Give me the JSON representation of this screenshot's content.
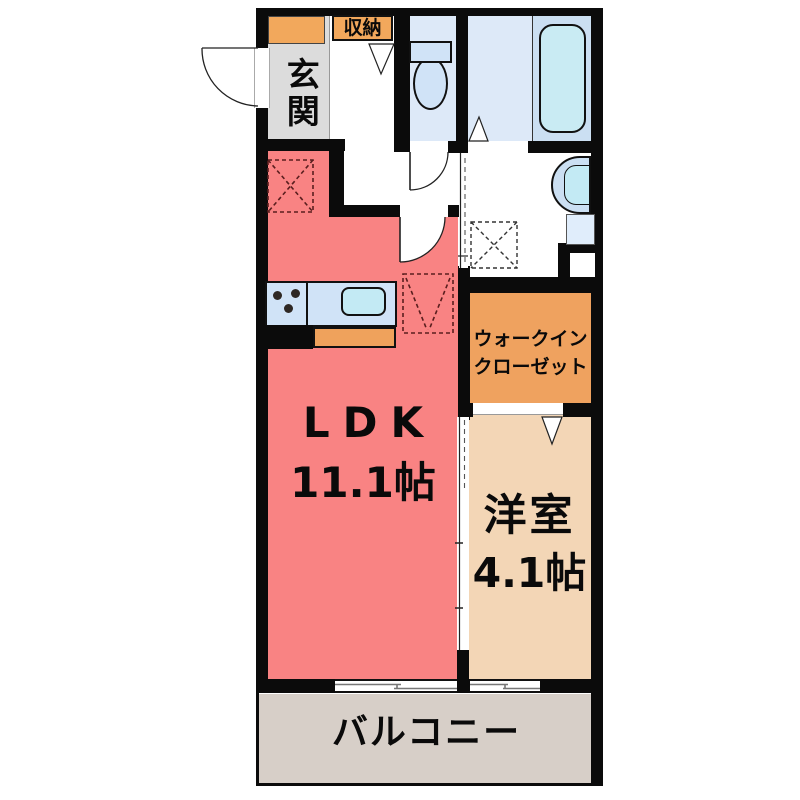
{
  "floorplan": {
    "rooms": {
      "genkan": {
        "label": "玄関"
      },
      "shuno": {
        "label": "収納"
      },
      "ldk": {
        "label": "LDK",
        "size": "11.1帖"
      },
      "wic": {
        "label_line1": "ウォークイン",
        "label_line2": "クローゼット"
      },
      "youshitsu": {
        "label": "洋室",
        "size": "4.1帖"
      },
      "balcony": {
        "label": "バルコニー"
      }
    },
    "colors": {
      "ldk": "#F98383",
      "youshitsu": "#F3D6B6",
      "wic": "#EFA25F",
      "accent_orange": "#F2A85C",
      "genkan_gray": "#DCDCDC",
      "balcony": "#D7CFC8",
      "bath_floor": "#DDE9F8",
      "tub_zone": "#CBDFF2",
      "fixture_blue": "#C3EAF4",
      "counter_blue": "#D0E3F7",
      "wall": "#0B0B0B"
    }
  }
}
